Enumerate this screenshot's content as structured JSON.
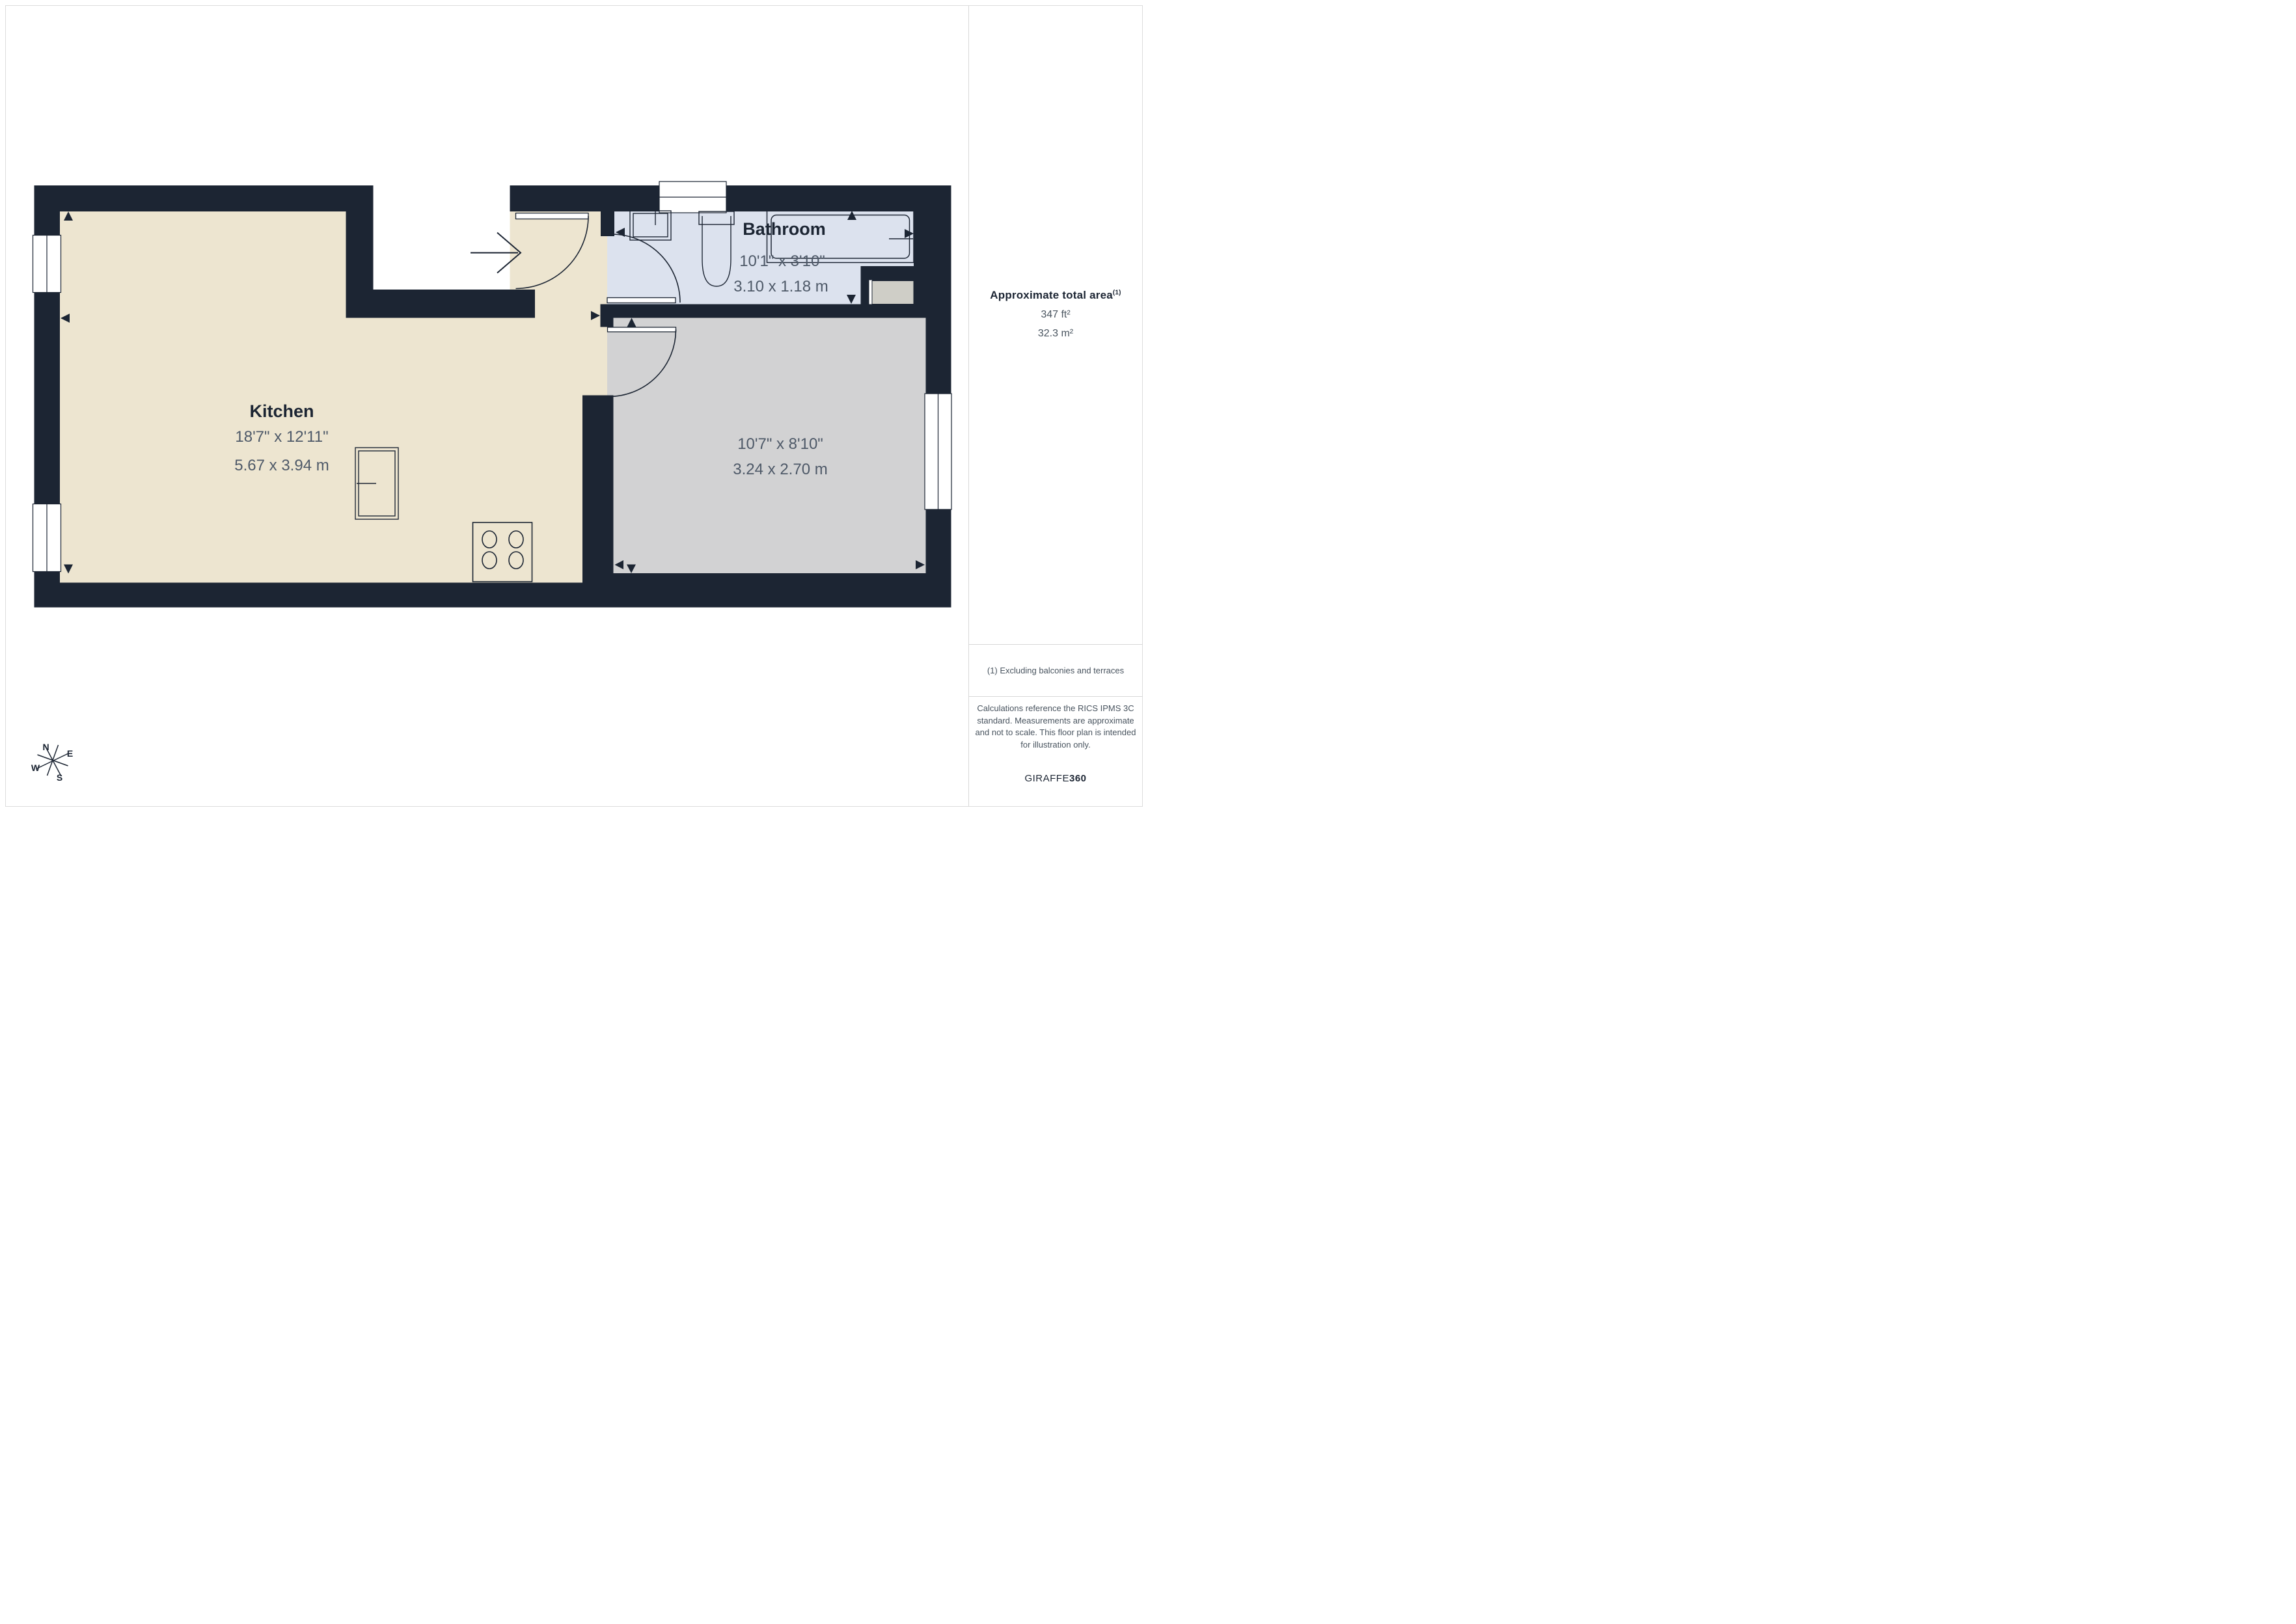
{
  "rooms": {
    "kitchen": {
      "name": "Kitchen",
      "imperial": "18'7\" x 12'11\"",
      "metric": "5.67 x 3.94 m"
    },
    "bathroom": {
      "name": "Bathroom",
      "imperial": "10'1\" x 3'10\"",
      "metric": "3.10 x 1.18 m"
    },
    "room2": {
      "imperial": "10'7\" x 8'10\"",
      "metric": "3.24 x 2.70 m"
    }
  },
  "compass": {
    "north": "N",
    "east": "E",
    "south": "S",
    "west": "W"
  },
  "sidebar": {
    "area_heading": "Approximate total area",
    "area_footnote_marker": "(1)",
    "area_ft": "347 ft²",
    "area_m": "32.3 m²",
    "footnote": "(1) Excluding balconies and terraces",
    "disclaimer": "Calculations reference the RICS IPMS 3C standard. Measurements are approximate and not to scale. This floor plan is intended for illustration only.",
    "brand_primary": "GIRAFFE",
    "brand_secondary": "360"
  },
  "colors": {
    "wall": "#1c2533",
    "kitchen_floor": "#ede5d0",
    "bathroom_floor": "#dce2ee",
    "room_floor": "#d2d2d3",
    "closet_floor": "#cfcec7",
    "dimension_text": "#4e5968",
    "divider": "#d8d8d8"
  }
}
